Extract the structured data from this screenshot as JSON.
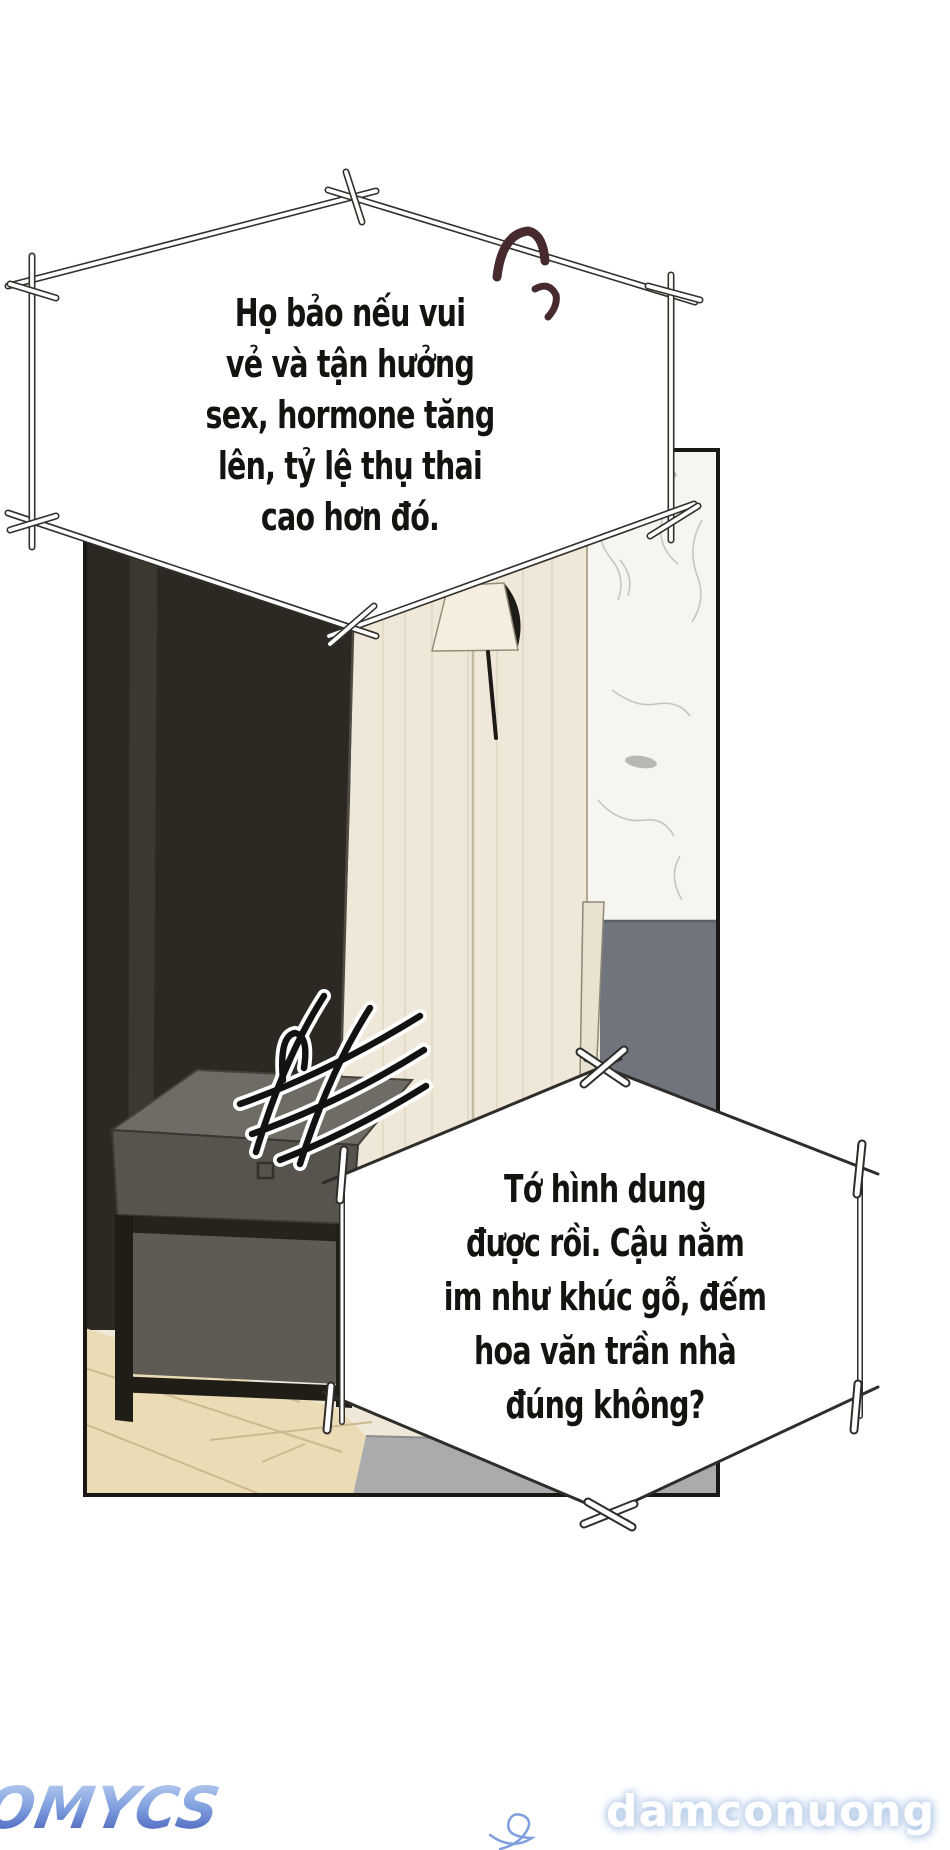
{
  "page": {
    "background": "#ffffff"
  },
  "panel": {
    "colors": {
      "border": "#1a1814",
      "dark_wall": "#2c2923",
      "wood_wall": "#efe7d7",
      "marble_wall": "#f6f5f2",
      "bed": "#70747d",
      "bed_post": "#eae2d0",
      "floor": "#ecdcb6",
      "rug_gray": "#a9abad",
      "nightstand_top": "#6f6c66",
      "nightstand_front": "#57544e",
      "lamp_shade": "#f4eede"
    }
  },
  "bubbles": {
    "bubble1": {
      "lines": [
        "Họ bảo nếu vui",
        "vẻ và tận hưởng",
        "sex, hormone tăng",
        "lên, tỷ lệ thụ thai",
        "cao hơn đó."
      ]
    },
    "bubble2": {
      "lines": [
        "Tớ hình dung",
        "được rồi. Cậu nằm",
        "im như khúc gỗ, đếm",
        "hoa văn trần nhà",
        "đúng không?"
      ]
    }
  },
  "decorations": {
    "ink_color": "#2f2d29",
    "laugh_marks_color": "#462a2e",
    "laugh_marks_icon": "laugh-strokes-icon",
    "hash_icon": "irritation-hash-icon"
  },
  "watermarks": {
    "logo_text": "VCOMYCS",
    "site_text": "damconuong",
    "logo_gradient_top": "#c2d6f2",
    "logo_gradient_mid": "#7e9ede",
    "logo_gradient_bottom": "#3f55b4",
    "site_glow": "#a8c2e4"
  }
}
